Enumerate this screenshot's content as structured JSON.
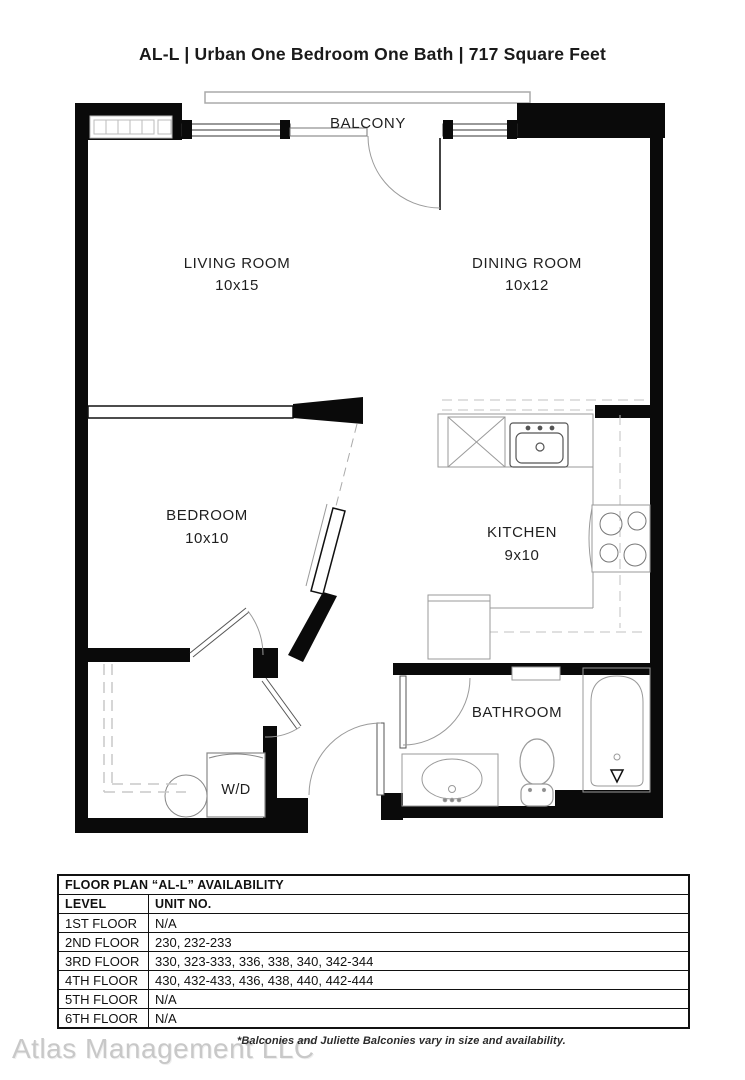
{
  "page": {
    "title": "AL-L | Urban One Bedroom One Bath | 717  Square Feet"
  },
  "floorplan": {
    "balcony_label": "BALCONY",
    "living": {
      "name": "LIVING ROOM",
      "dims": "10x15"
    },
    "dining": {
      "name": "DINING ROOM",
      "dims": "10x12"
    },
    "bedroom": {
      "name": "BEDROOM",
      "dims": "10x10"
    },
    "kitchen": {
      "name": "KITCHEN",
      "dims": "9x10"
    },
    "bathroom": {
      "name": "BATHROOM"
    },
    "washer_dryer_label": "W/D"
  },
  "availability": {
    "title": "FLOOR PLAN “AL-L” AVAILABILITY",
    "columns": [
      "LEVEL",
      "UNIT NO."
    ],
    "rows": [
      {
        "level": "1ST FLOOR",
        "units": "N/A"
      },
      {
        "level": "2ND FLOOR",
        "units": "230, 232-233"
      },
      {
        "level": "3RD FLOOR",
        "units": "330, 323-333, 336, 338, 340, 342-344"
      },
      {
        "level": "4TH FLOOR",
        "units": "430, 432-433, 436, 438, 440, 442-444"
      },
      {
        "level": "5TH FLOOR",
        "units": "N/A"
      },
      {
        "level": "6TH FLOOR",
        "units": "N/A"
      }
    ]
  },
  "footer": {
    "company": "Atlas Management LLC",
    "disclaimer": "*Balconies and Juliette Balconies vary in size and availability."
  },
  "colors": {
    "wall": "#0a0a0a",
    "fixture_line": "#9a9a9a",
    "watermark": "#c8c8c8"
  }
}
